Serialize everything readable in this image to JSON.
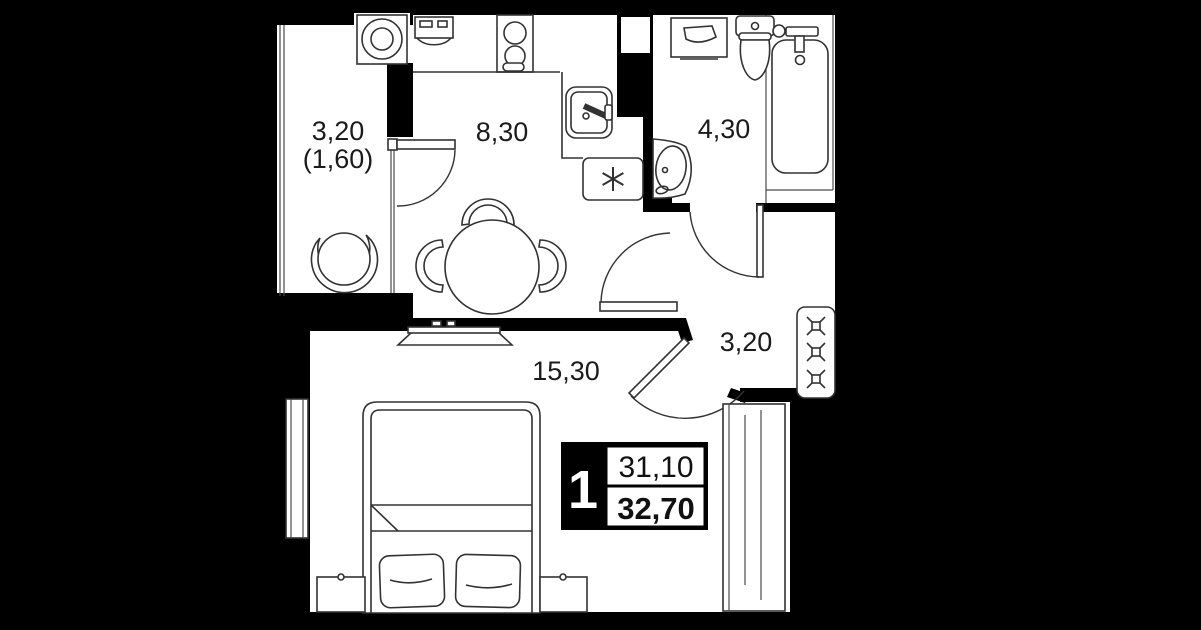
{
  "plan": {
    "labels": {
      "balcony_area": "3,20",
      "balcony_area_reduced": "(1,60)",
      "kitchen_area": "8,30",
      "bathroom_area": "4,30",
      "hallway_area": "3,20",
      "living_area": "15,30"
    },
    "badge": {
      "rooms_count": "1",
      "living_space": "31,10",
      "total_space": "32,70"
    },
    "colors": {
      "background": "#000000",
      "floor": "#ffffff",
      "line": "#323232"
    }
  }
}
